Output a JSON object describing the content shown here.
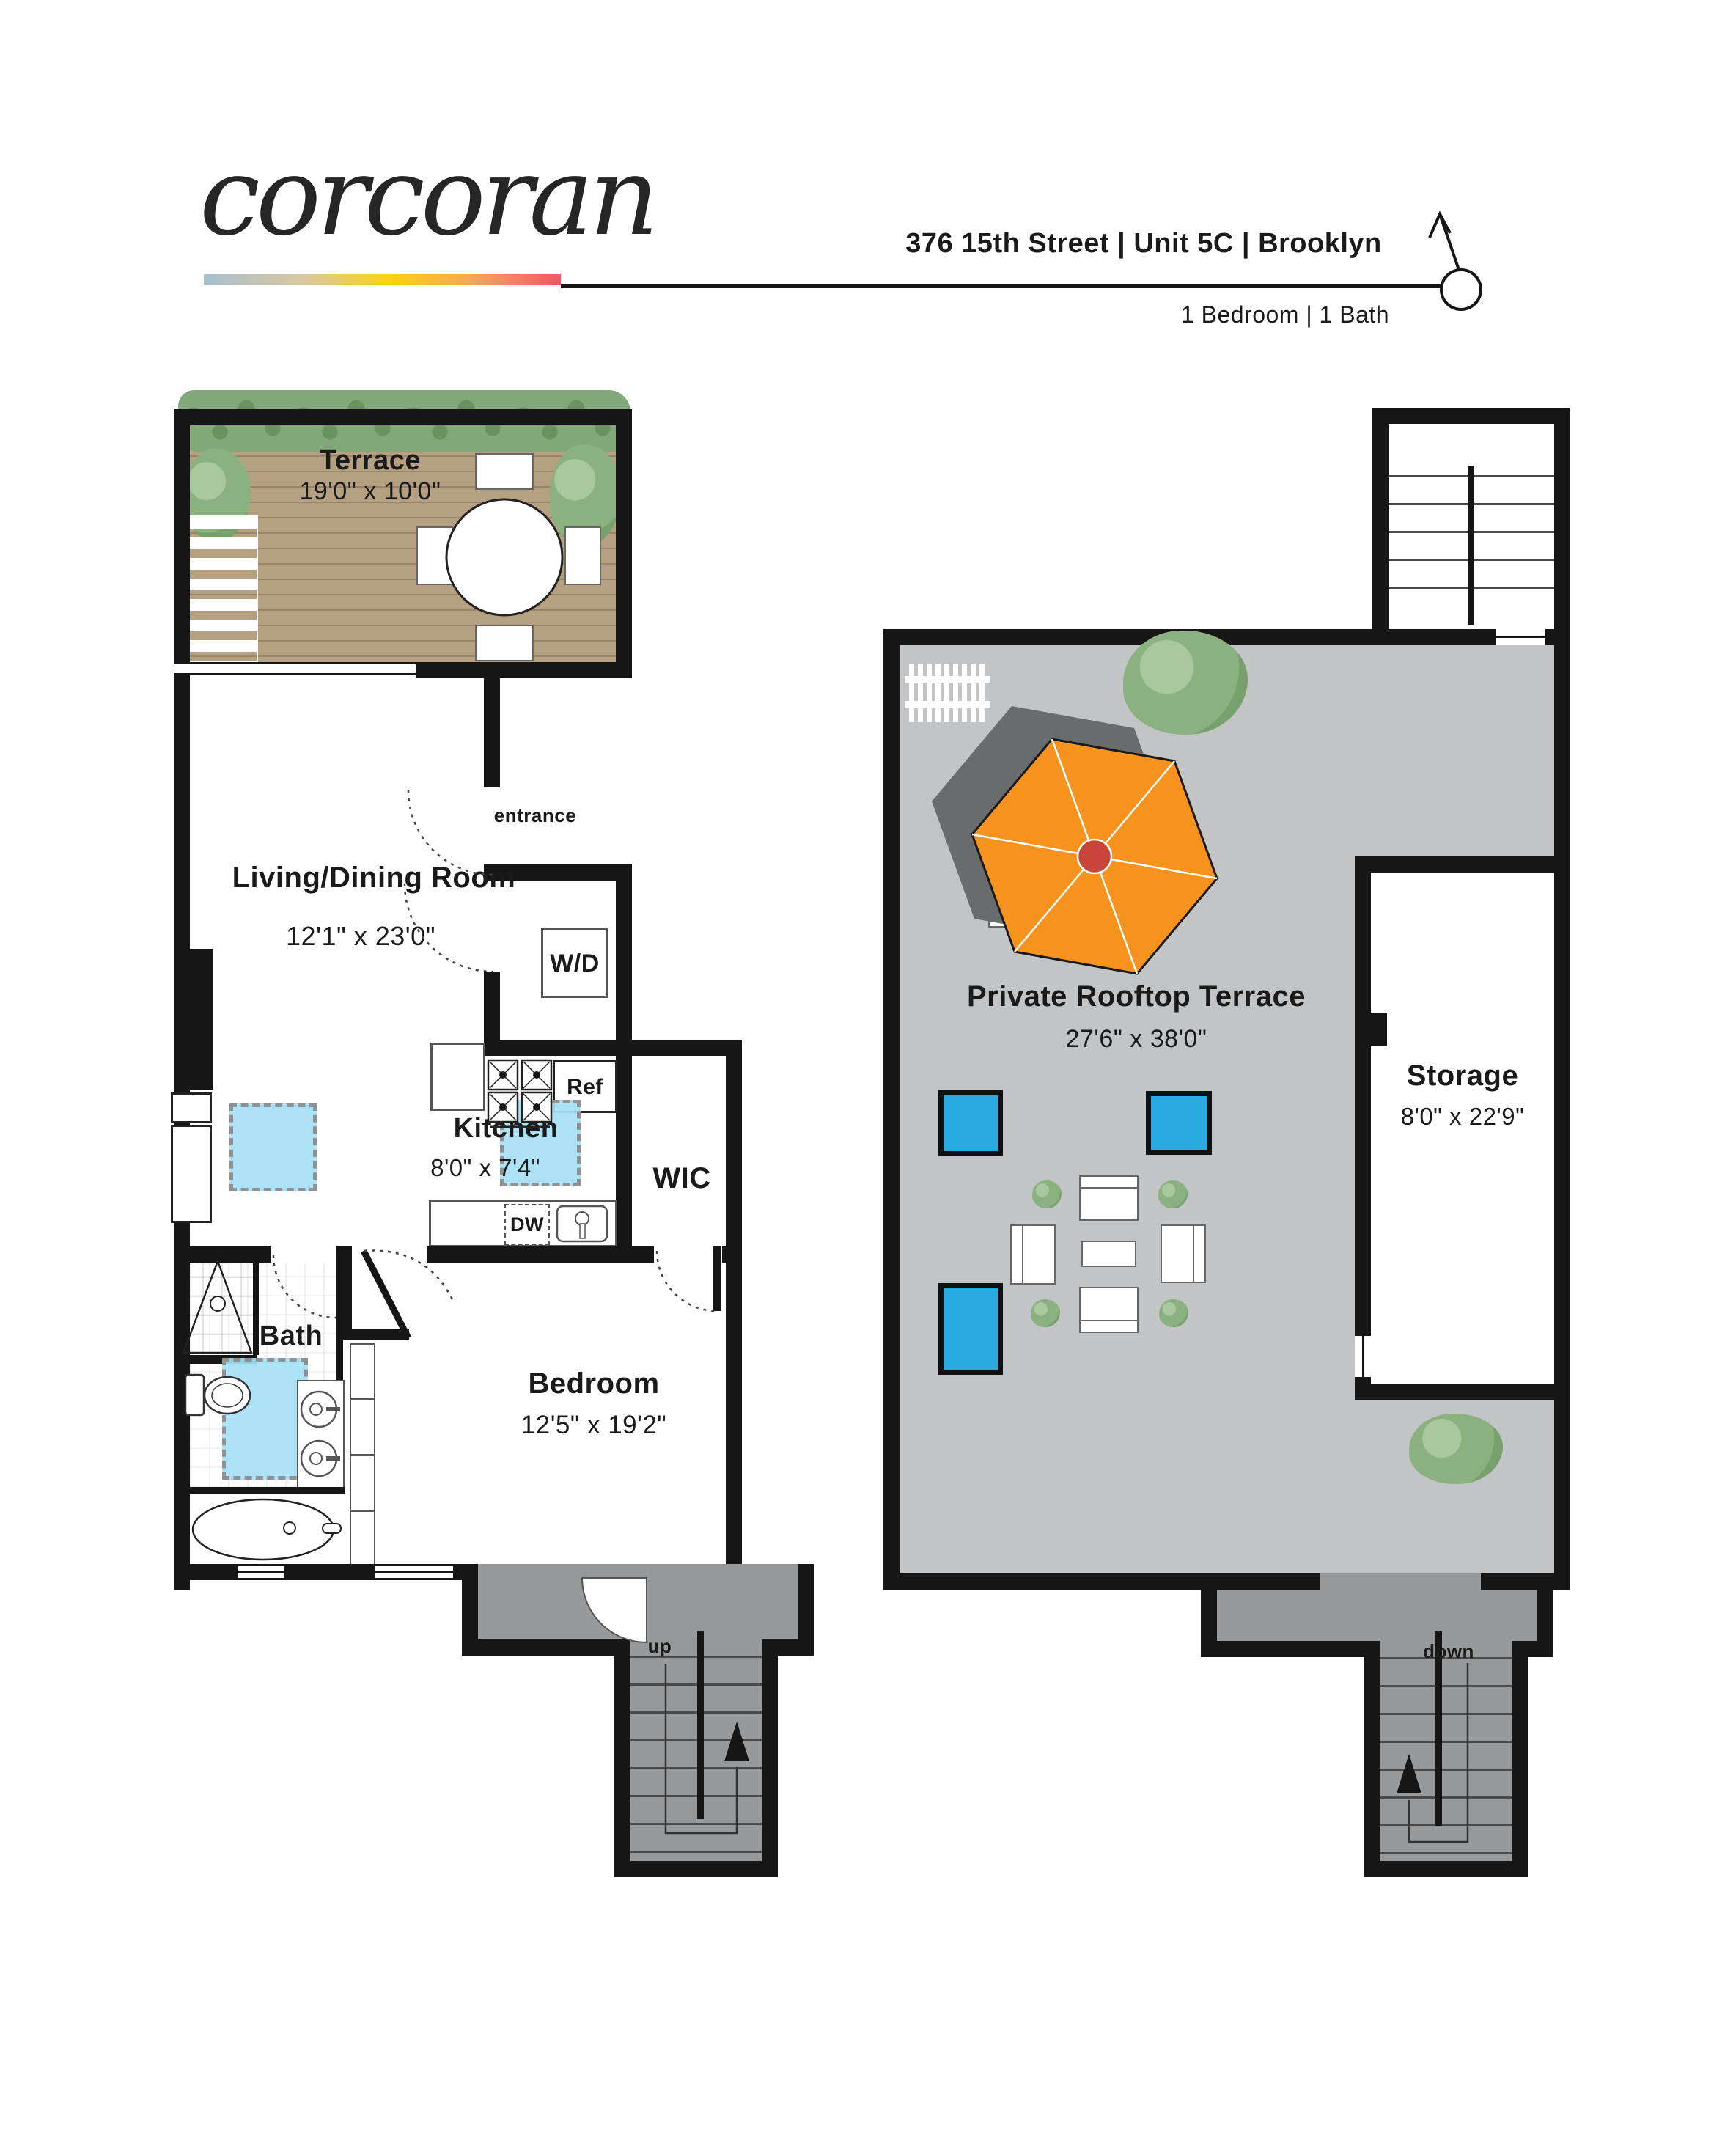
{
  "header": {
    "brand": "corcoran",
    "address": "376 15th Street | Unit 5C | Brooklyn",
    "summary": "1 Bedroom | 1 Bath",
    "compass": "N"
  },
  "floor1": {
    "terrace": {
      "name": "Terrace",
      "dims": "19'0\" x 10'0\""
    },
    "living": {
      "name": "Living/Dining Room",
      "dims": "12'1\" x 23'0\""
    },
    "entrance": "entrance",
    "washer_dryer": "W/D",
    "kitchen": {
      "name": "Kitchen",
      "dims": "8'0\" x 7'4\""
    },
    "refrigerator": "Ref",
    "dishwasher": "DW",
    "closet": "WIC",
    "bath": "Bath",
    "bedroom": {
      "name": "Bedroom",
      "dims": "12'5\" x 19'2\""
    },
    "stair": "up"
  },
  "floor2": {
    "terrace": {
      "name": "Private Rooftop Terrace",
      "dims": "27'6\" x 38'0\""
    },
    "storage": {
      "name": "Storage",
      "dims": "8'0\" x 22'9\""
    },
    "stair": "down"
  },
  "colors": {
    "wall": "#161616",
    "deck_tan": "#b5a081",
    "hedge_green": "#82a779",
    "rooftop_gray": "#c3c4c6",
    "stair_gray": "#98999b",
    "skylight_blue": "#29abe2",
    "highlight_blue": "#a6dff5",
    "umbrella_orange": "#f6921e",
    "umbrella_center_red": "#c9453a",
    "logo_gradient": [
      "#a8bfcf",
      "#d9c9a0",
      "#fdd014",
      "#f7a45b",
      "#ee5766"
    ]
  }
}
